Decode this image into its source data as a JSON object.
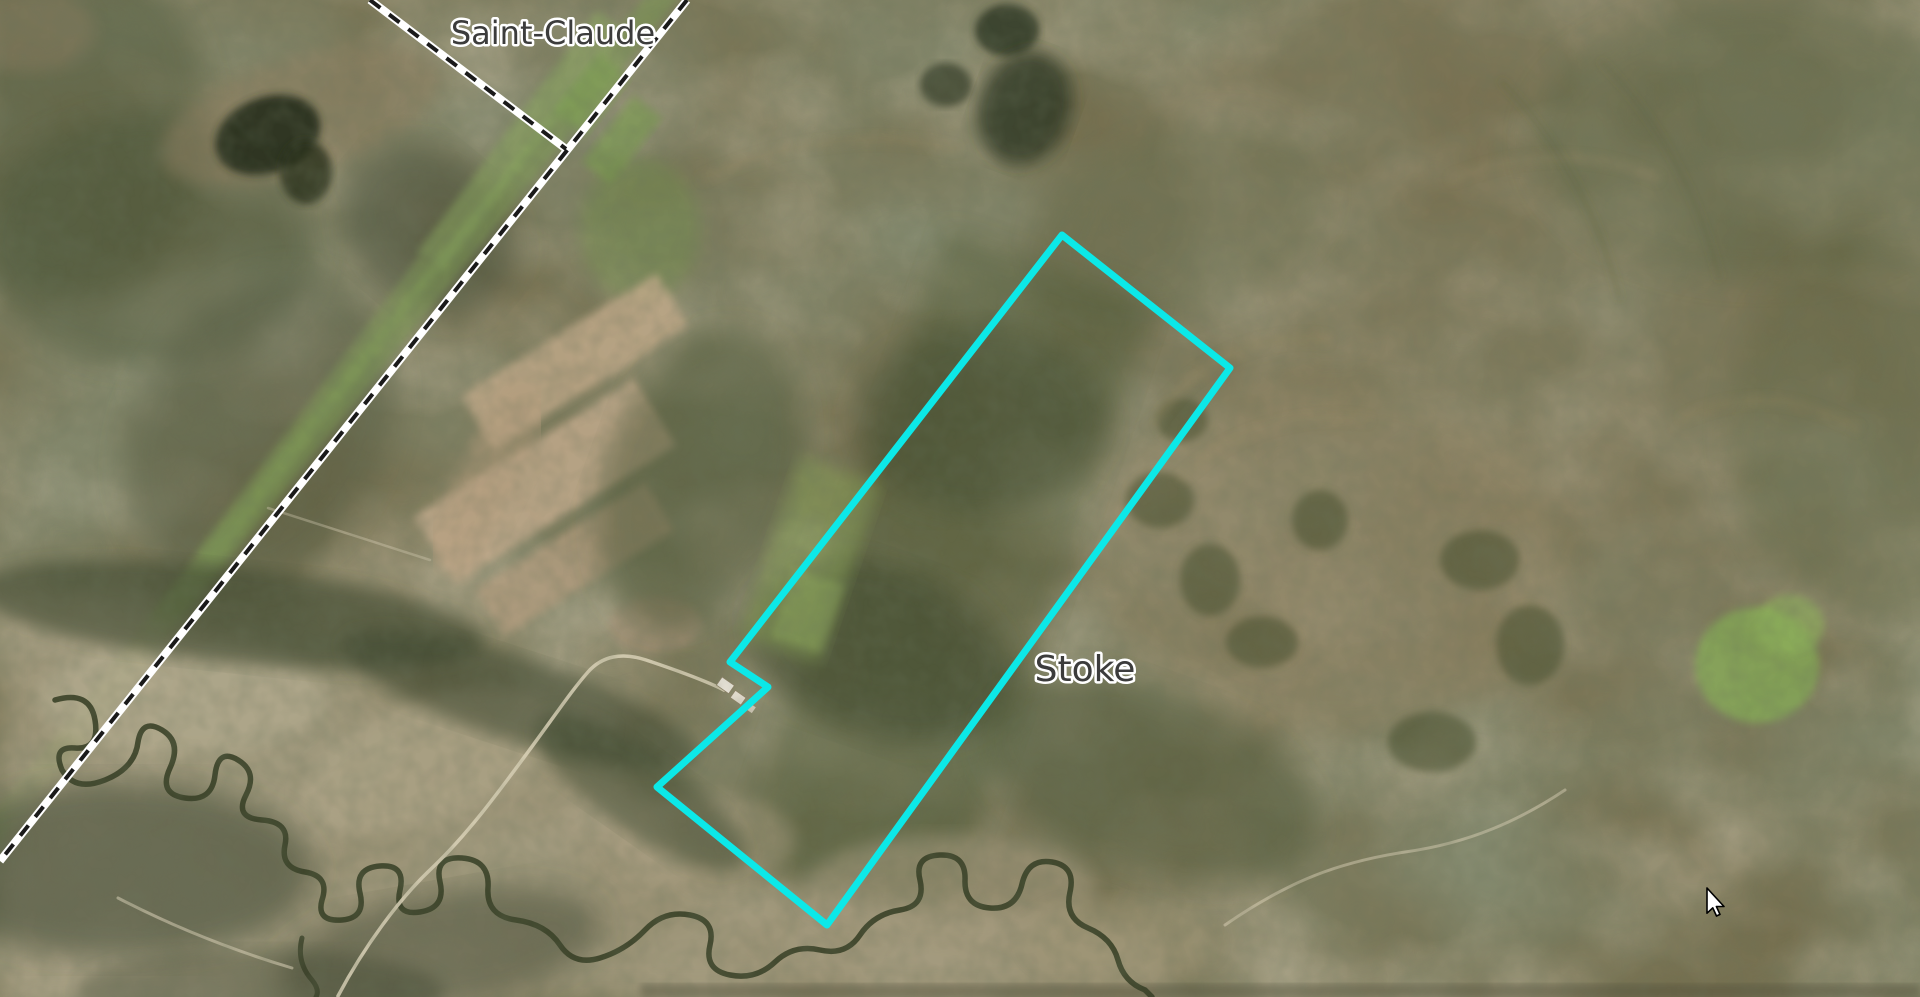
{
  "map": {
    "view": "satellite-imagery",
    "labels": {
      "saint_claude": {
        "text": "Saint-Claude"
      },
      "stoke": {
        "text": "Stoke"
      }
    },
    "overlays": {
      "property_outline": {
        "color": "#0ce8e8",
        "points": "1062,235 1230,368 827,925 657,787 768,687 730,662"
      },
      "municipal_boundary": {
        "band_color": "#ffffff",
        "dash_color": "#1a1a1a",
        "main_points": "687,0 0,861",
        "branch_points": "370,0 566,149"
      }
    },
    "cursor": {
      "transform": "translate(1707,888)"
    }
  }
}
